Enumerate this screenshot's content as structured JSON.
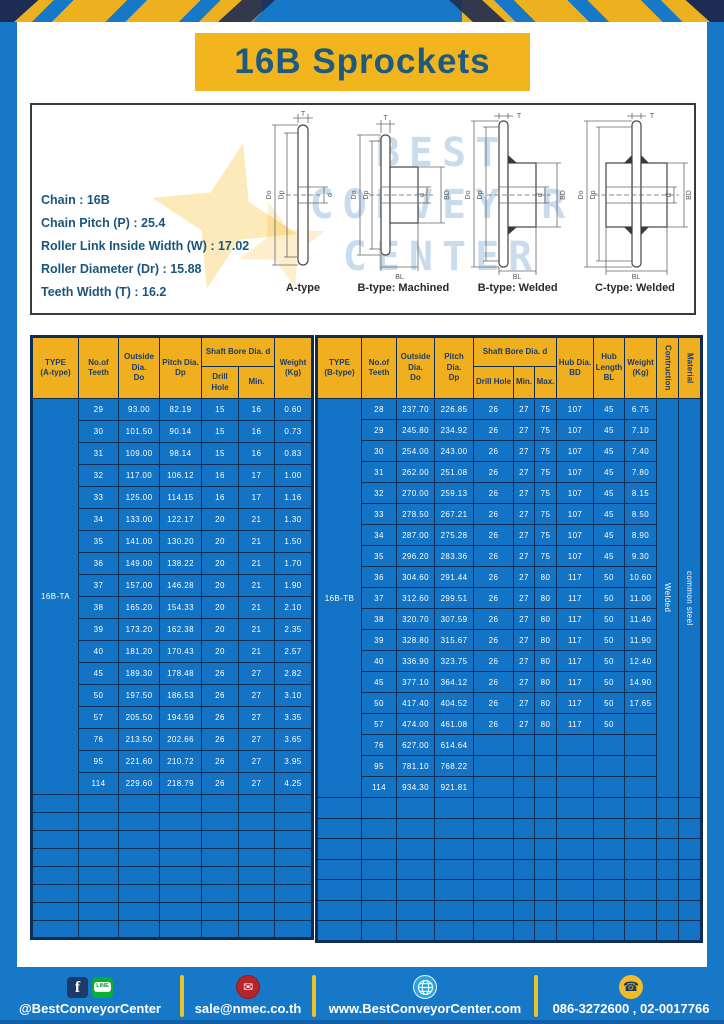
{
  "page": {
    "title": "16B Sprockets"
  },
  "info": {
    "specs": [
      "Chain  :  16B",
      "Chain Pitch (P)  :  25.4",
      "Roller Link Inside Width (W)  :  17.02",
      "Roller Diameter (Dr)  : 15.88",
      "Teeth Width (T)  :  16.2"
    ],
    "captions": [
      "A-type",
      "B-type: Machined",
      "B-type: Welded",
      "C-type: Welded"
    ],
    "watermark": [
      "BEST",
      "CONVEYOR",
      "CENTER"
    ],
    "dims": {
      "t": "T",
      "do": "Do",
      "dp": "Dp",
      "d": "d",
      "bd": "BD",
      "bl": "BL"
    }
  },
  "tables": [
    {
      "type_value": "16B-TA",
      "cols": 7,
      "empty_rows": 8,
      "headers": {
        "type": "TYPE\n(A-type)",
        "teeth": "No.of\nTeeth",
        "outside": "Outside\nDia.\nDo",
        "pitch": "Pitch Dia.\nDp",
        "shaft": "Shaft Bore Dia. d",
        "drill": "Drill Hole",
        "min": "Min.",
        "weight": "Weight\n(Kg)"
      },
      "rows": [
        [
          "29",
          "93.00",
          "82.19",
          "15",
          "16",
          "0.60"
        ],
        [
          "30",
          "101.50",
          "90.14",
          "15",
          "16",
          "0.73"
        ],
        [
          "31",
          "109.00",
          "98.14",
          "15",
          "16",
          "0.83"
        ],
        [
          "32",
          "117.00",
          "106.12",
          "16",
          "17",
          "1.00"
        ],
        [
          "33",
          "125.00",
          "114.15",
          "16",
          "17",
          "1.16"
        ],
        [
          "34",
          "133.00",
          "122.17",
          "20",
          "21",
          "1.30"
        ],
        [
          "35",
          "141.00",
          "130.20",
          "20",
          "21",
          "1.50"
        ],
        [
          "36",
          "149.00",
          "138.22",
          "20",
          "21",
          "1.70"
        ],
        [
          "37",
          "157.00",
          "146.28",
          "20",
          "21",
          "1.90"
        ],
        [
          "38",
          "165.20",
          "154.33",
          "20",
          "21",
          "2.10"
        ],
        [
          "39",
          "173.20",
          "162.38",
          "20",
          "21",
          "2.35"
        ],
        [
          "40",
          "181.20",
          "170.43",
          "20",
          "21",
          "2.57"
        ],
        [
          "45",
          "189.30",
          "178.48",
          "26",
          "27",
          "2.82"
        ],
        [
          "50",
          "197.50",
          "186.53",
          "26",
          "27",
          "3.10"
        ],
        [
          "57",
          "205.50",
          "194.59",
          "26",
          "27",
          "3.35"
        ],
        [
          "76",
          "213.50",
          "202.66",
          "26",
          "27",
          "3.65"
        ],
        [
          "95",
          "221.60",
          "210.72",
          "26",
          "27",
          "3.95"
        ],
        [
          "114",
          "229.60",
          "218.79",
          "26",
          "27",
          "4.25"
        ]
      ]
    },
    {
      "type_value": "16B-TB",
      "cols": 12,
      "empty_rows": 7,
      "construction": "Welded",
      "material": "common steel",
      "headers": {
        "type": "TYPE\n(B-type)",
        "teeth": "No.of\nTeeth",
        "outside": "Outside\nDia.\nDo",
        "pitch": "Pitch Dia.\nDp",
        "shaft": "Shaft Bore Dia. d",
        "drill": "Drill Hole",
        "min": "Min.",
        "max": "Max.",
        "hub_dia": "Hub Dia.\nBD",
        "hub_len": "Hub\nLength\nBL",
        "weight": "Weight\n(Kg)",
        "construction": "Contruction",
        "material": "Material"
      },
      "rows": [
        [
          "28",
          "237.70",
          "226.85",
          "26",
          "27",
          "75",
          "107",
          "45",
          "6.75"
        ],
        [
          "29",
          "245.80",
          "234.92",
          "26",
          "27",
          "75",
          "107",
          "45",
          "7.10"
        ],
        [
          "30",
          "254.00",
          "243.00",
          "26",
          "27",
          "75",
          "107",
          "45",
          "7.40"
        ],
        [
          "31",
          "262.00",
          "251.08",
          "26",
          "27",
          "75",
          "107",
          "45",
          "7.80"
        ],
        [
          "32",
          "270.00",
          "259.13",
          "26",
          "27",
          "75",
          "107",
          "45",
          "8.15"
        ],
        [
          "33",
          "278.50",
          "267.21",
          "26",
          "27",
          "75",
          "107",
          "45",
          "8.50"
        ],
        [
          "34",
          "287.00",
          "275.28",
          "26",
          "27",
          "75",
          "107",
          "45",
          "8.90"
        ],
        [
          "35",
          "296.20",
          "283.36",
          "26",
          "27",
          "75",
          "107",
          "45",
          "9.30"
        ],
        [
          "36",
          "304.60",
          "291.44",
          "26",
          "27",
          "80",
          "117",
          "50",
          "10.60"
        ],
        [
          "37",
          "312.60",
          "299.51",
          "26",
          "27",
          "80",
          "117",
          "50",
          "11.00"
        ],
        [
          "38",
          "320.70",
          "307.59",
          "26",
          "27",
          "80",
          "117",
          "50",
          "11.40"
        ],
        [
          "39",
          "328.80",
          "315.67",
          "26",
          "27",
          "80",
          "117",
          "50",
          "11.90"
        ],
        [
          "40",
          "336.90",
          "323.75",
          "26",
          "27",
          "80",
          "117",
          "50",
          "12.40"
        ],
        [
          "45",
          "377.10",
          "364.12",
          "26",
          "27",
          "80",
          "117",
          "50",
          "14.90"
        ],
        [
          "50",
          "417.40",
          "404.52",
          "26",
          "27",
          "80",
          "117",
          "50",
          "17.65"
        ],
        [
          "57",
          "474.00",
          "461.08",
          "26",
          "27",
          "80",
          "117",
          "50",
          ""
        ],
        [
          "76",
          "627.00",
          "614.64",
          "",
          "",
          "",
          "",
          "",
          ""
        ],
        [
          "95",
          "781.10",
          "768.22",
          "",
          "",
          "",
          "",
          "",
          ""
        ],
        [
          "114",
          "934.30",
          "921.81",
          "",
          "",
          "",
          "",
          "",
          ""
        ]
      ]
    }
  ],
  "footer": {
    "items": [
      {
        "label": "@BestConveyorCenter"
      },
      {
        "label": "sale@nmec.co.th"
      },
      {
        "label": "www.BestConveyorCenter.com"
      },
      {
        "label": "086-3272600 , 02-0017766"
      }
    ],
    "glyphs": {
      "facebook": "f",
      "line": "LINE",
      "mail": "✉",
      "phone": "☎"
    }
  },
  "colors": {
    "frame_blue": "#1878c8",
    "cell_blue": "#1373c4",
    "grid_navy": "#0e2d55",
    "header_amber": "#f0af1f",
    "banner_yellow": "#f2b51e",
    "title_text": "#1e5a7d",
    "stripe_navy": "#1d2c52"
  }
}
